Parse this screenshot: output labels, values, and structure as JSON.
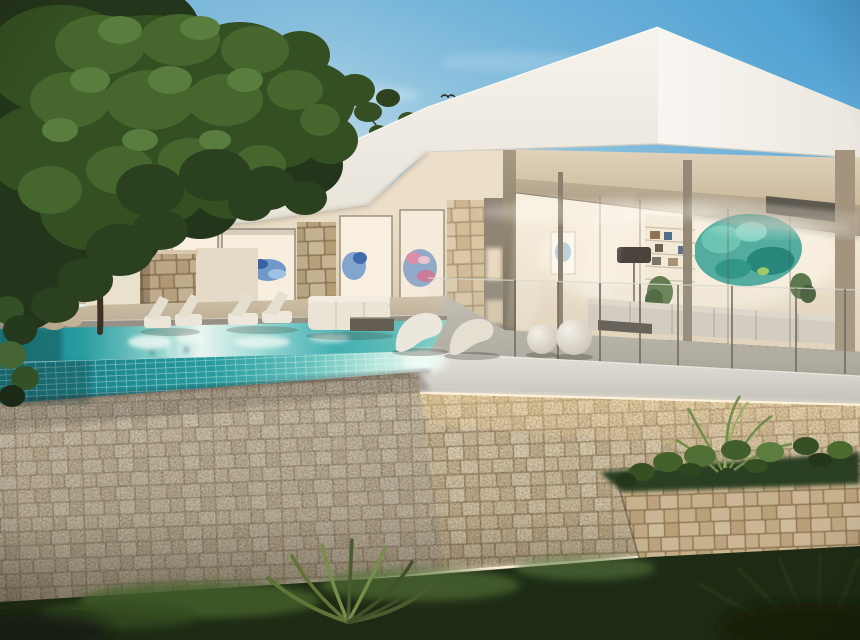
{
  "scene": {
    "type": "architectural-render",
    "subject": "Modern white villa with infinity pool, stone retaining walls and garden at dusk",
    "sky": {
      "zenith": "#3f9ad4",
      "mid": "#7cbade",
      "band": "#c3dfeb",
      "horizon": "#edf4f3",
      "cloud": "#ffffff"
    },
    "roof": {
      "left_face_top": "#f7f5f0",
      "left_face_bottom": "#e7e3da",
      "right_face_light": "#f8f7f4",
      "right_face_dark": "#ebe8e2",
      "edge_shadow": "#c9c3b6",
      "slat": "#f2f0e9"
    },
    "facade": {
      "wall_top": "#ecdfca",
      "wall_bottom": "#d6c7ae",
      "interior_glow": "#f8f0e2",
      "frame": "#8a8274",
      "stone_column": "#d8c3a2",
      "recess": "#8d8274"
    },
    "glass_box": {
      "interior_top": "#f8f0df",
      "interior_bottom": "#e3d3ba",
      "soffit_light": "#e0d3bb",
      "soffit_dark": "#c6b498",
      "beam": "#bcad96",
      "post_light": "#a2977f",
      "post_dark": "#6e6553",
      "header": "#57534c",
      "sofa": "#d3ccc0",
      "lamp_shade": "#423d37",
      "bookshelf": "#f2ead9",
      "table": "#56514a"
    },
    "art": {
      "blue_main": "#4a7fc1",
      "blue_deep": "#2a55a0",
      "blue_light": "#8fb4e0",
      "teal_main": "#34a095",
      "teal_light": "#66c4b4",
      "teal_deep": "#1f8478",
      "pink": "#d98ba8"
    },
    "pool": {
      "deep": "#0f7e88",
      "teal": "#1e98a0",
      "reflection": "#e8f6f2",
      "tile_dark": "#0d6b76",
      "tile_mid": "#1f9aa0",
      "tile_light": "#b7e8e0",
      "tile_glow": "#e4f7f0",
      "coping": "#938d83",
      "waterline": "#eafaf4"
    },
    "terrace": {
      "warm_floor": "#cdbfa8",
      "warm_floor_dark": "#b3a48c",
      "gray_floor": "#c0bcb2",
      "gray_floor_dark": "#a39e93",
      "fascia_top": "#e3e2dc",
      "fascia_mid": "#d4d3cd",
      "fascia_bottom": "#bdbcb5",
      "led": "#fff3dc",
      "sphere_light": "#f4f1ea",
      "sphere_dark": "#c2bcb0",
      "balustrade_post": "#6b6458"
    },
    "stone": {
      "warm_block": "#d9c6a4",
      "warm_joint": "#96815f",
      "cool_tint": "#8c8e8c",
      "glow": "#ffda96"
    },
    "vegetation": {
      "canopy_dark": "#1b2e14",
      "canopy_mid": "#2c4a1d",
      "canopy_light": "#3e6128",
      "canopy_highlight": "#52793a",
      "ground_dark": "#15240e",
      "ground_lit": "#4a682e",
      "palm": "#5a7034",
      "trunk": "#342a1e"
    },
    "furniture": {
      "white": "#ece7dc",
      "white_dark": "#ddd6c8",
      "lamp_orb": "#ffffff"
    },
    "bird": "#222222"
  }
}
